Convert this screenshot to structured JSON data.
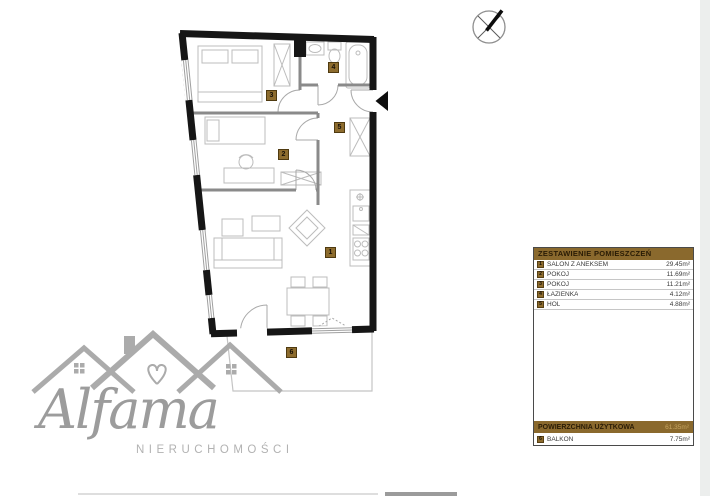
{
  "legend": {
    "title": "ZESTAWIENIE POMIESZCZEŃ",
    "rows": [
      {
        "num": "1",
        "label": "SALON Z ANEKSEM",
        "area": "29.45m²"
      },
      {
        "num": "2",
        "label": "POKÓJ",
        "area": "11.69m²"
      },
      {
        "num": "3",
        "label": "POKÓJ",
        "area": "11.21m²"
      },
      {
        "num": "4",
        "label": "ŁAZIENKA",
        "area": "4.12m²"
      },
      {
        "num": "5",
        "label": "HOL",
        "area": "4.88m²"
      }
    ],
    "total_label": "POWIERZCHNIA UŻYTKOWA",
    "total_area": "61.35m²",
    "balcony": {
      "num": "6",
      "label": "BALKON",
      "area": "7.75m²"
    }
  },
  "plan": {
    "markers": [
      {
        "num": "1"
      },
      {
        "num": "2"
      },
      {
        "num": "3"
      },
      {
        "num": "4"
      },
      {
        "num": "5"
      },
      {
        "num": "6"
      }
    ]
  },
  "logo": {
    "brand": "Alfama",
    "subtitle": "NIERUCHOMOŚCI"
  },
  "icons": {
    "compass": "north-compass-icon",
    "entrance": "entrance-arrow-icon"
  },
  "colors": {
    "accent_brown": "#8a692d",
    "marker_border": "#4f3a10",
    "wall_black": "#161616",
    "furniture_gray": "#bcbcbc",
    "logo_gray": "#ababab",
    "total_value_tan": "#c8a661"
  }
}
